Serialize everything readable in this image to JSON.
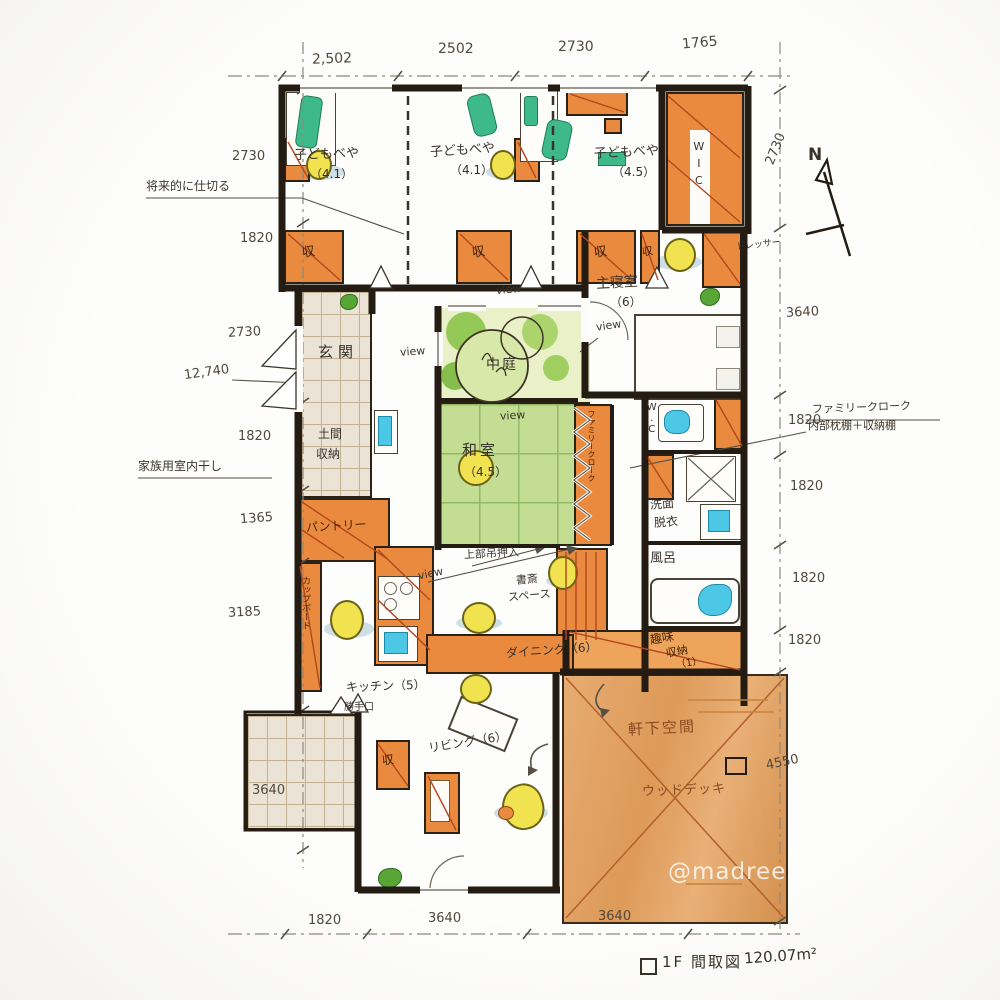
{
  "watermark": "@madree",
  "compass": {
    "label": "N"
  },
  "footer": {
    "title": "1F 間取図",
    "area": "120.07m²"
  },
  "dims": {
    "top": [
      "2,502",
      "2502",
      "2730",
      "1765"
    ],
    "bottom": [
      "1820",
      "3640",
      "3640"
    ],
    "left": [
      "2730",
      "1820",
      "2730",
      "12,740",
      "1820",
      "1365",
      "3185",
      "3640"
    ],
    "right": [
      "2730",
      "3640",
      "1820",
      "1820",
      "1820",
      "1820",
      "4550"
    ]
  },
  "rooms": {
    "kids1": {
      "name": "子どもべや",
      "size": "（4.1）"
    },
    "kids2": {
      "name": "子どもべや",
      "size": "（4.1）"
    },
    "kids3": {
      "name": "子どもべや",
      "size": "（4.5）"
    },
    "wic": "WIC",
    "genkan": "玄関",
    "doma": {
      "l1": "土間",
      "l2": "収納"
    },
    "pantry": "パントリー",
    "cupboard": "カップボード",
    "courtyard": "中庭",
    "washitsu": {
      "name": "和室",
      "size": "（4.5）"
    },
    "master": {
      "name": "主寝室",
      "size": "（6）"
    },
    "dresser": "ドレッサー",
    "wc": "W.C",
    "senmen": {
      "l1": "洗面",
      "l2": "脱衣"
    },
    "bath": "風呂",
    "hobby": {
      "l1": "趣味",
      "l2": "収納",
      "l3": "（1）"
    },
    "familycloak": "ファミリークローク",
    "study": {
      "l1": "書斎",
      "l2": "スペース"
    },
    "dining": "ダイニング（6）",
    "kitchen": "キッチン（5）",
    "backdoor": "勝手口",
    "living": "リビング（6）",
    "eaves": "軒下空間",
    "deck": "ウッドデッキ",
    "closet": "収"
  },
  "notes": {
    "future_partition": "将来的に仕切る",
    "indoor_drying": "家族用室内干し",
    "cloak1": "ファミリークローク",
    "cloak2": "内部枕棚＋収納棚",
    "upper_closet": "上部吊押入",
    "view": "view"
  }
}
